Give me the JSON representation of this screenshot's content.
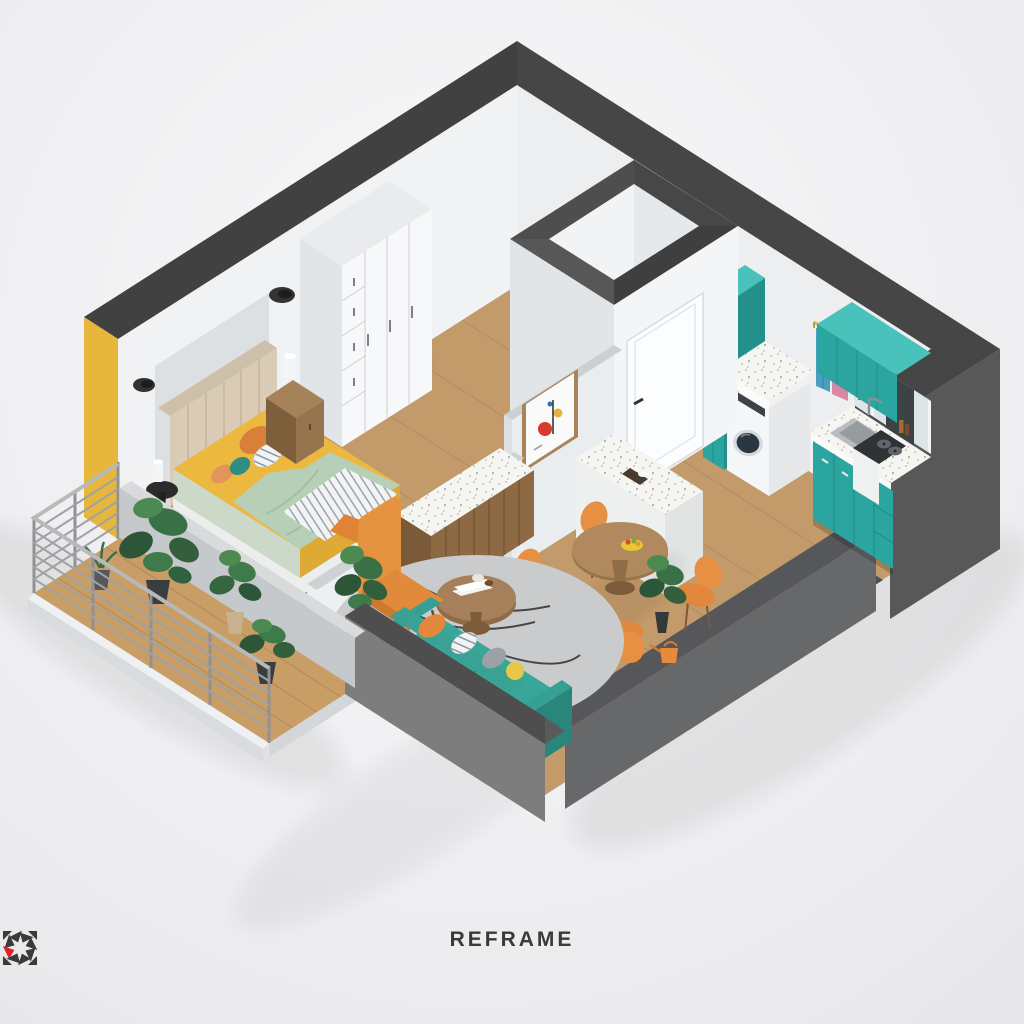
{
  "logo": {
    "text": "REFRAME"
  },
  "palette": {
    "background": "#f1f1f3",
    "wall_top_dark": "#464646",
    "wall_side_dark": "#565656",
    "wall_side_mid": "#6f6f6f",
    "wall_side_light": "#7d7d7d",
    "wall_inner": "#eef0f2",
    "low_wall_top": "#55575a",
    "parapet_gray": "#c6c9cc",
    "floor_wood": "#c39a6a",
    "deck_wood": "#c89d66",
    "teal": "#2ba5a0",
    "teal_light": "#49c2bb",
    "teal_dark": "#23908b",
    "sofa_teal": "#38a79a",
    "orange": "#e68a3c",
    "yellow_accent": "#e7b63c",
    "bed_yellow": "#ecb83f",
    "sage": "#b7cfb6",
    "terrazzo": "#f5f5f2",
    "rug_gray": "#c9cbcc",
    "bedroom_rug_teal": "#3f9e94",
    "wood_furniture": "#8e6a44",
    "steel": "#a8aaab",
    "plant_green": "#3a7046",
    "clothes_blue": "#4a9ec0",
    "clothes_pink": "#d887a5",
    "washer_door": "#2a3742",
    "logo_red": "#e02128",
    "logo_dark": "#3a3a3a"
  },
  "scene": {
    "type": "isometric-apartment-floor-plan-render",
    "rooms": [
      {
        "name": "bedroom",
        "furniture": [
          "wardrobe",
          "double-bed",
          "nightstand",
          "side-table",
          "wall-lamps",
          "area-rug"
        ]
      },
      {
        "name": "bathroom",
        "furniture": []
      },
      {
        "name": "hallway",
        "furniture": [
          "bathroom-door",
          "wall-art"
        ]
      },
      {
        "name": "laundry-nook",
        "furniture": [
          "tall-cabinet",
          "washing-machine",
          "countertop",
          "clothes-rail",
          "hanging-clothes"
        ]
      },
      {
        "name": "kitchen",
        "furniture": [
          "upper-cabinets",
          "glass-cabinets",
          "countertop",
          "sink",
          "base-cabinets",
          "cooktop",
          "floor-mat"
        ]
      },
      {
        "name": "dining-area",
        "furniture": [
          "round-table",
          "four-chairs",
          "fruit-bowl",
          "island-counter"
        ]
      },
      {
        "name": "living-area",
        "furniture": [
          "corner-sofa",
          "armchair",
          "coffee-table",
          "round-rug",
          "sideboard",
          "plants",
          "watering-can"
        ]
      },
      {
        "name": "balcony",
        "furniture": [
          "metal-railing",
          "potted-plants",
          "wood-deck"
        ]
      }
    ]
  }
}
